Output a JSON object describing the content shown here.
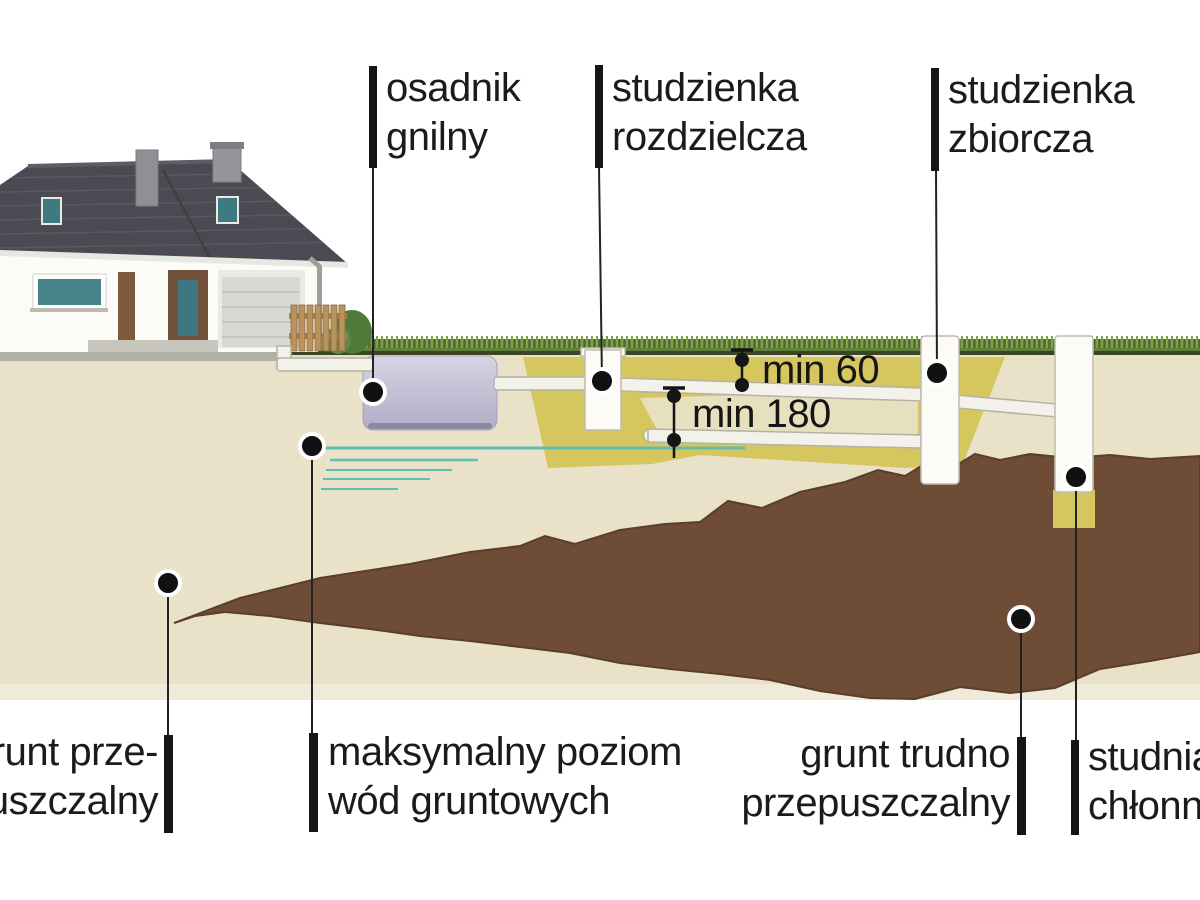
{
  "callouts": {
    "septic_tank": {
      "line1": "osadnik",
      "line2": "gnilny"
    },
    "distribution_well": {
      "line1": "studzienka",
      "line2": "rozdzielcza"
    },
    "collection_well": {
      "line1": "studzienka",
      "line2": "zbiorcza"
    },
    "absorption_well": {
      "line1": "studnia",
      "line2": "chłonna"
    },
    "permeable_soil": {
      "line1": "grunt prze-",
      "line2": "puszczalny"
    },
    "groundwater_level": {
      "line1": "maksymalny poziom",
      "line2": "wód gruntowych"
    },
    "impermeable_soil": {
      "line1": "grunt trudno",
      "line2": "przepuszczalny"
    }
  },
  "dimensions": {
    "upper_pipe_depth": "min 60",
    "lower_pipe_depth": "min 180"
  },
  "colors": {
    "background": "#ffffff",
    "soil": "#e9e2c9",
    "soil_light": "#f0ead9",
    "sand_fill": "#d5c75e",
    "clay": "#6e4c36",
    "groundwater": "#5fbdb2",
    "tank": "#c3bdd3",
    "pipe": "#f3f2ea",
    "well": "#fcfbf6",
    "grass": "#62803c",
    "pavement": "#b2afa4",
    "roof": "#4a4a52",
    "callout": "#151515"
  }
}
